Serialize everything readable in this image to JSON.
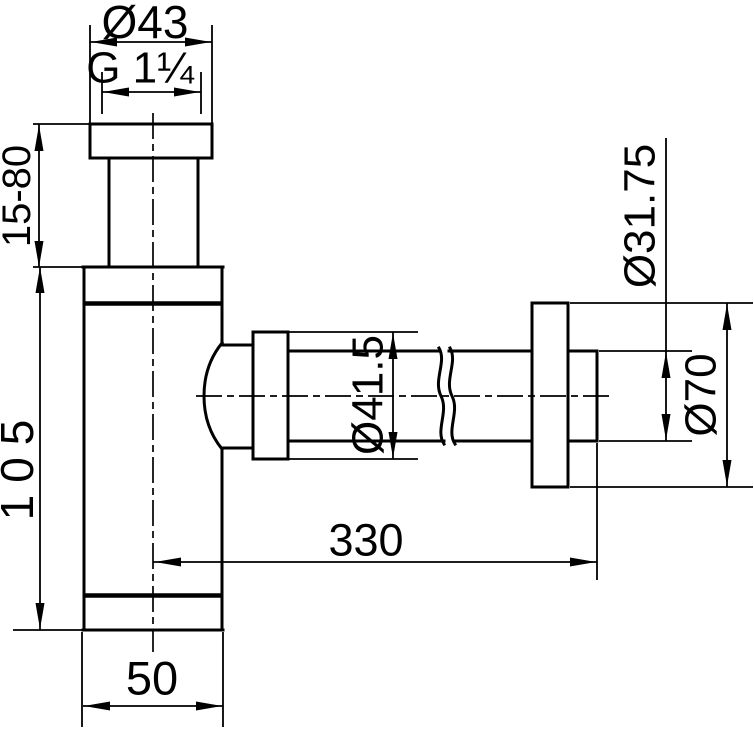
{
  "page": {
    "background_color": "#ffffff",
    "line_color": "#000000"
  },
  "drawing": {
    "labels": {
      "inlet_nut_diameter": "Ø43",
      "inlet_thread": "G 1¼",
      "inlet_adjustable_height": "15-80",
      "body_height": "105",
      "outlet_nut_diameter": "Ø41.5",
      "wall_pipe_diameter": "Ø31.75",
      "wall_flange_diameter": "Ø70",
      "outlet_pipe_length": "330",
      "body_width": "50"
    }
  }
}
